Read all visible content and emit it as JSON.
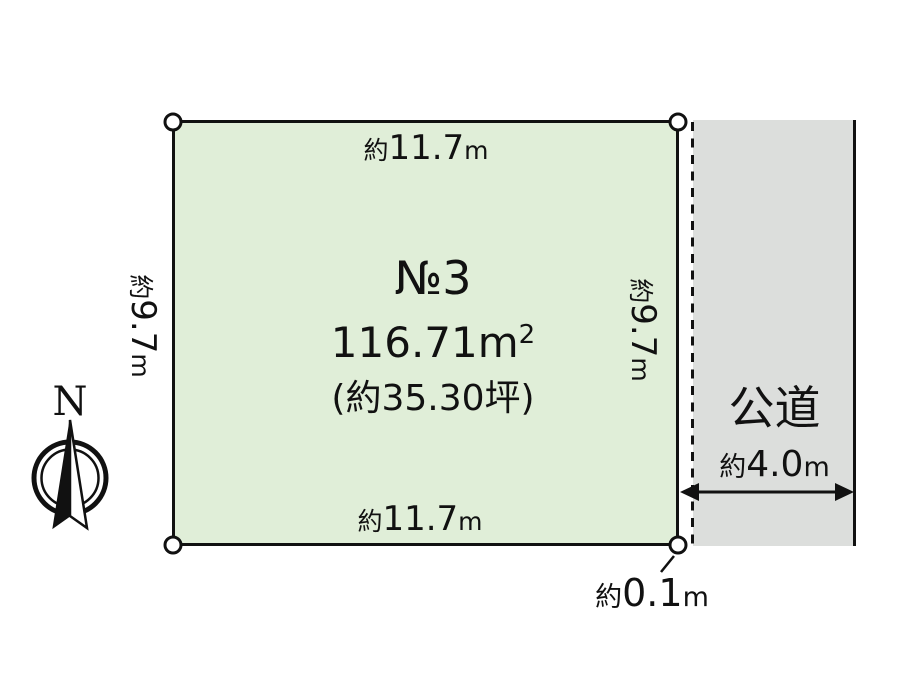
{
  "diagram": {
    "title_semantic": "land-plot-site-plan",
    "plot": {
      "number": {
        "prefix": "№",
        "value": "3"
      },
      "area": {
        "value": "116.71",
        "unit": "m",
        "unit_sup": "2"
      },
      "area_tsubo": {
        "open": "(",
        "text": "約35.30坪",
        "close": ")"
      },
      "dims": {
        "top": {
          "prefix": "約",
          "value": "11.7",
          "unit": "m"
        },
        "bottom": {
          "prefix": "約",
          "value": "11.7",
          "unit": "m"
        },
        "left": {
          "prefix": "約",
          "value": "9.7",
          "unit": "m"
        },
        "right": {
          "prefix": "約",
          "value": "9.7",
          "unit": "m"
        }
      },
      "fill_color": "#e0eed8"
    },
    "road": {
      "label": "公道",
      "width": {
        "prefix": "約",
        "value": "4.0",
        "unit": "m"
      },
      "fill_color": "#dcdedc"
    },
    "offset": {
      "prefix": "約",
      "value": "0.1",
      "unit": "m"
    },
    "compass": {
      "label": "N"
    },
    "line_color": "#111111"
  }
}
